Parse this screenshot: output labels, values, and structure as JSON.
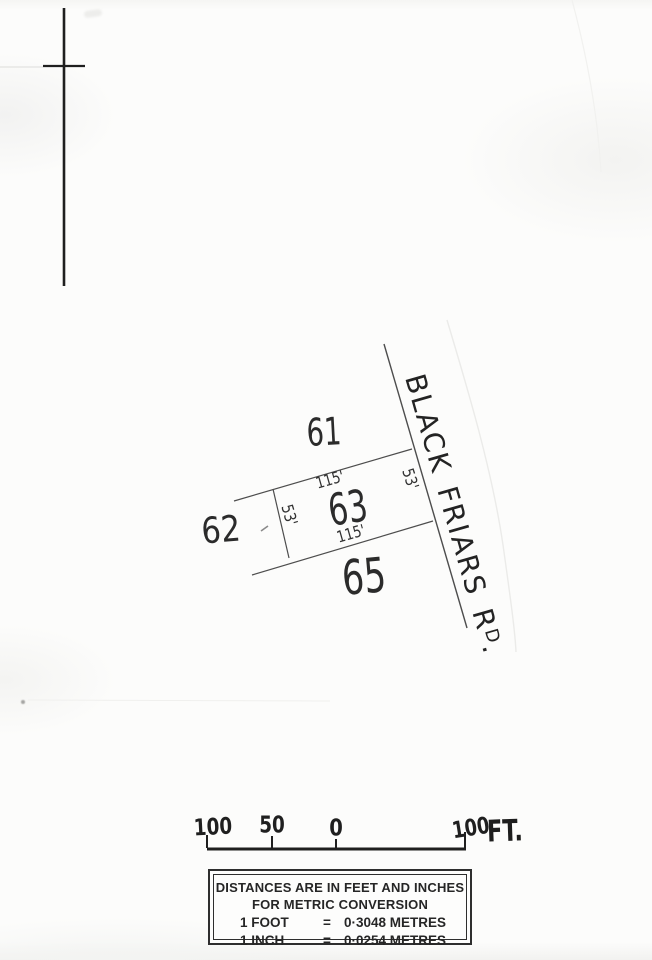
{
  "colors": {
    "paper": "#fcfcfb",
    "ink": "#2b2b2b",
    "line": "#4d4d4d"
  },
  "plat": {
    "lots": {
      "lot61": "61",
      "lot62": "62",
      "lot63": "63",
      "lot65": "65"
    },
    "dims": {
      "north": "115'",
      "south": "115'",
      "west": "53'",
      "east": "53'"
    },
    "road": {
      "name": "BLACK FRIARS",
      "abbrev_r": "R",
      "abbrev_d": "D",
      "period": "."
    }
  },
  "scale_bar": {
    "labels": [
      "100",
      "50",
      "0",
      "100"
    ],
    "unit": "FT."
  },
  "conversion_box": {
    "title_line1": "DISTANCES ARE IN FEET AND INCHES",
    "title_line2": "FOR METRIC CONVERSION",
    "rows": [
      {
        "qty": "1 FOOT",
        "eq": "=",
        "val": "0·3048 METRES"
      },
      {
        "qty": "1 INCH",
        "eq": "=",
        "val": "0·0254 METRES"
      }
    ]
  }
}
